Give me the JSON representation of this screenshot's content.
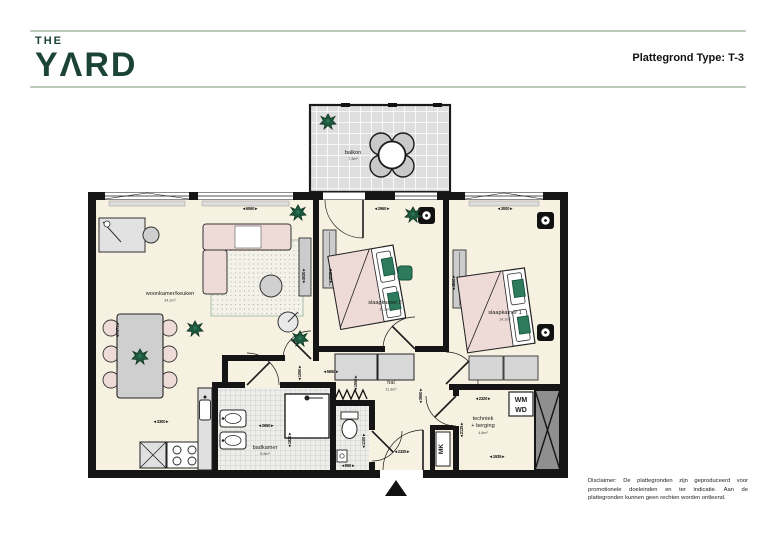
{
  "header": {
    "logo_line1": "THE",
    "logo_line2": "YΛRD",
    "plan_type_label": "Plattegrond Type: T-3"
  },
  "plan": {
    "rooms": [
      {
        "name": "woonkamer/keuken",
        "area": "34,1m²"
      },
      {
        "name": "slaapkamer 2",
        "area": "11,2m²"
      },
      {
        "name": "slaapkamer 1",
        "area": "14,1m²"
      },
      {
        "name": "hal",
        "area": "11,3m²"
      },
      {
        "name": "badkamer",
        "area": "5,6m²"
      },
      {
        "name_line1": "techniek",
        "name_line2": "+ berging",
        "area": "4,6m²"
      },
      {
        "name": "balkon",
        "area": "7,3m²"
      }
    ],
    "labels": {
      "mk": "MK",
      "wm": "WM",
      "wd": "WD"
    },
    "dims": {
      "woonkamer_width": "6060",
      "slaapkamer2_width": "2960",
      "slaapkamer1_width": "3000",
      "woonkamer_depth": "4020",
      "slaapkamer2_depth": "4020",
      "slaapkamer1_depth": "4840",
      "woonkamer_length": "7071",
      "kitchen_width": "3300",
      "badkamer_width": "2650",
      "badkamer_depth": "1820",
      "hal_width": "5650",
      "hal_a": "1050",
      "hal_b": "1550",
      "hal_c": "3550",
      "entree_width": "2325",
      "toilet_width": "950",
      "toilet_depth": "1100",
      "techniek_width": "2320",
      "techniek_depth": "2125",
      "techniek_b": "1935"
    },
    "colors": {
      "wall": "#151515",
      "floor": "#f7f1e1",
      "accent_green": "#1e5a40",
      "furniture_pink": "#eedbd8",
      "header_rule": "#b9cdb9",
      "logo_green": "#1b4434"
    }
  },
  "disclaimer": {
    "text": "Disclaimer: De plattegronden zijn geproduceerd voor promotionele doeleinden en ter indicatie. Aan de plattegronden kunnen geen rechten worden ontleend."
  }
}
